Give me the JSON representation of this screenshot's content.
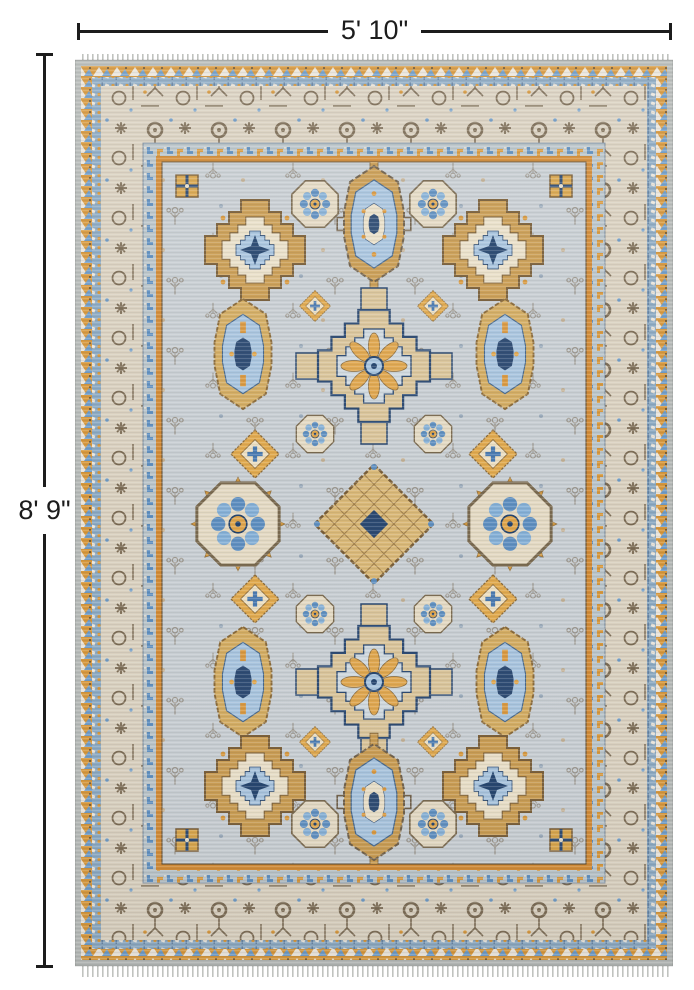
{
  "dimensions": {
    "width_label": "5' 10\"",
    "height_label": "8' 9\""
  },
  "palette": {
    "background": "#ffffff",
    "dimension_line": "#1c1c1c",
    "rug_field": "#c7cdd2",
    "rug_border_beige": "#d9d0bf",
    "rug_gold": "#d6973c",
    "rug_orange_stripe": "#d28a35",
    "rug_tan": "#d3ac62",
    "rug_navy": "#2c4a72",
    "rug_blue": "#5f8fc0",
    "rug_light_blue": "#a8c4de",
    "rug_brown": "#6b5942",
    "rug_cream": "#e9dfc8",
    "rug_selvedge": "#b6bab8"
  }
}
